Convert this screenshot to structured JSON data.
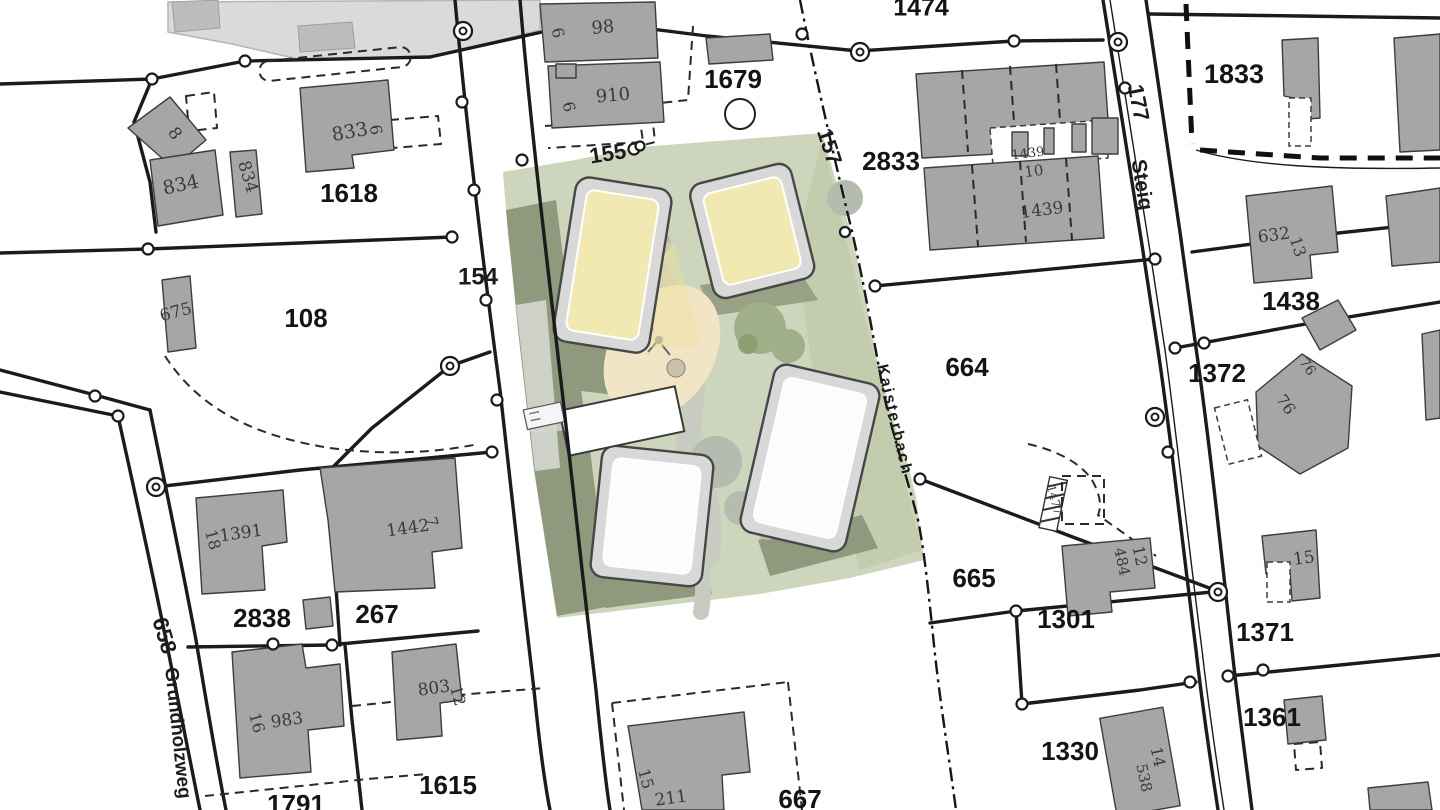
{
  "map": {
    "type": "cadastral-site-plan",
    "colors": {
      "background": "#ffffff",
      "boundary_line": "#1b1b1b",
      "building_fill": "#a6a6a6",
      "pale_building_fill": "#dadada",
      "site_green": "#cdd6bc",
      "site_shadow": "#8f997d",
      "roof_yellow": "#f2e8b2",
      "roof_white": "#fcfcfc",
      "playground_sand": "#f1e5c5",
      "path_gray": "#c7cbc0"
    },
    "labels": {
      "parcels": [
        {
          "text": "1474",
          "x": 921,
          "y": 9,
          "rot": 0,
          "size": 25
        },
        {
          "text": "1679",
          "x": 733,
          "y": 81,
          "rot": 0,
          "size": 26
        },
        {
          "text": "2833",
          "x": 891,
          "y": 163,
          "rot": 0,
          "size": 26
        },
        {
          "text": "1833",
          "x": 1234,
          "y": 76,
          "rot": 0,
          "size": 27
        },
        {
          "text": "1618",
          "x": 349,
          "y": 195,
          "rot": 0,
          "size": 26
        },
        {
          "text": "108",
          "x": 306,
          "y": 320,
          "rot": 0,
          "size": 26
        },
        {
          "text": "1438",
          "x": 1291,
          "y": 303,
          "rot": 0,
          "size": 26
        },
        {
          "text": "1372",
          "x": 1217,
          "y": 375,
          "rot": 0,
          "size": 26
        },
        {
          "text": "664",
          "x": 967,
          "y": 369,
          "rot": 0,
          "size": 26
        },
        {
          "text": "665",
          "x": 974,
          "y": 580,
          "rot": 0,
          "size": 26
        },
        {
          "text": "1301",
          "x": 1066,
          "y": 621,
          "rot": 0,
          "size": 26
        },
        {
          "text": "1371",
          "x": 1265,
          "y": 634,
          "rot": 0,
          "size": 26
        },
        {
          "text": "1361",
          "x": 1272,
          "y": 719,
          "rot": 0,
          "size": 26
        },
        {
          "text": "1330",
          "x": 1070,
          "y": 753,
          "rot": 0,
          "size": 26
        },
        {
          "text": "2838",
          "x": 262,
          "y": 620,
          "rot": 0,
          "size": 26
        },
        {
          "text": "267",
          "x": 377,
          "y": 616,
          "rot": 0,
          "size": 26
        },
        {
          "text": "1615",
          "x": 448,
          "y": 787,
          "rot": 0,
          "size": 26
        },
        {
          "text": "1791",
          "x": 296,
          "y": 806,
          "rot": 0,
          "size": 26
        },
        {
          "text": "667",
          "x": 800,
          "y": 801,
          "rot": 0,
          "size": 26
        }
      ],
      "streets": [
        {
          "text": "154",
          "x": 478,
          "y": 278,
          "rot": 0,
          "size": 24
        },
        {
          "text": "155",
          "x": 608,
          "y": 155,
          "rot": -9,
          "size": 22
        },
        {
          "text": "157",
          "x": 828,
          "y": 147,
          "rot": 72,
          "size": 22
        },
        {
          "text": "177",
          "x": 1137,
          "y": 103,
          "rot": 79,
          "size": 22
        },
        {
          "text": "658",
          "x": 163,
          "y": 636,
          "rot": 73,
          "size": 22
        },
        {
          "text": "Steig",
          "x": 1141,
          "y": 185,
          "rot": 81,
          "size": 21
        },
        {
          "text": "Grundholzweg",
          "x": 177,
          "y": 733,
          "rot": 84,
          "size": 19
        },
        {
          "text": "Kaisterbach",
          "x": 894,
          "y": 420,
          "rot": 77,
          "size": 16,
          "ls": 2
        }
      ],
      "buildings": [
        {
          "text": "834",
          "x": 181,
          "y": 186,
          "rot": -12,
          "size": 19
        },
        {
          "text": "834",
          "x": 247,
          "y": 177,
          "rot": 73,
          "size": 17
        },
        {
          "text": "8",
          "x": 174,
          "y": 134,
          "rot": 55,
          "size": 17
        },
        {
          "text": "833",
          "x": 350,
          "y": 133,
          "rot": -10,
          "size": 19
        },
        {
          "text": "6",
          "x": 375,
          "y": 130,
          "rot": 80,
          "size": 16
        },
        {
          "text": "98",
          "x": 603,
          "y": 28,
          "rot": -5,
          "size": 18
        },
        {
          "text": "6",
          "x": 557,
          "y": 33,
          "rot": 76,
          "size": 16
        },
        {
          "text": "910",
          "x": 613,
          "y": 96,
          "rot": -5,
          "size": 18
        },
        {
          "text": "6",
          "x": 568,
          "y": 107,
          "rot": 76,
          "size": 16
        },
        {
          "text": "675",
          "x": 176,
          "y": 313,
          "rot": -15,
          "size": 17
        },
        {
          "text": "1439",
          "x": 1028,
          "y": 154,
          "rot": -7,
          "size": 13
        },
        {
          "text": "10",
          "x": 1034,
          "y": 172,
          "rot": -7,
          "size": 15
        },
        {
          "text": "1439",
          "x": 1042,
          "y": 211,
          "rot": -7,
          "size": 17
        },
        {
          "text": "632",
          "x": 1274,
          "y": 236,
          "rot": -8,
          "size": 17
        },
        {
          "text": "13",
          "x": 1297,
          "y": 247,
          "rot": 72,
          "size": 16
        },
        {
          "text": "76",
          "x": 1285,
          "y": 405,
          "rot": 55,
          "size": 16
        },
        {
          "text": "76",
          "x": 1307,
          "y": 367,
          "rot": 55,
          "size": 14
        },
        {
          "text": "1391",
          "x": 241,
          "y": 534,
          "rot": -8,
          "size": 17
        },
        {
          "text": "18",
          "x": 212,
          "y": 540,
          "rot": 75,
          "size": 16
        },
        {
          "text": "1442",
          "x": 408,
          "y": 529,
          "rot": -8,
          "size": 17
        },
        {
          "text": "7",
          "x": 431,
          "y": 522,
          "rot": 75,
          "size": 15
        },
        {
          "text": "983",
          "x": 287,
          "y": 721,
          "rot": -8,
          "size": 17
        },
        {
          "text": "16",
          "x": 256,
          "y": 723,
          "rot": 75,
          "size": 16
        },
        {
          "text": "803",
          "x": 434,
          "y": 689,
          "rot": -8,
          "size": 17
        },
        {
          "text": "12",
          "x": 457,
          "y": 696,
          "rot": 75,
          "size": 16
        },
        {
          "text": "211",
          "x": 671,
          "y": 799,
          "rot": -8,
          "size": 17
        },
        {
          "text": "15",
          "x": 645,
          "y": 779,
          "rot": 75,
          "size": 16
        },
        {
          "text": "484",
          "x": 1121,
          "y": 562,
          "rot": 78,
          "size": 15
        },
        {
          "text": "12",
          "x": 1139,
          "y": 556,
          "rot": 78,
          "size": 16
        },
        {
          "text": "538",
          "x": 1143,
          "y": 778,
          "rot": 78,
          "size": 15
        },
        {
          "text": "14",
          "x": 1157,
          "y": 757,
          "rot": 78,
          "size": 16
        },
        {
          "text": "15",
          "x": 1304,
          "y": 559,
          "rot": -8,
          "size": 17
        },
        {
          "text": "1477",
          "x": 1054,
          "y": 500,
          "rot": 75,
          "size": 12
        }
      ]
    }
  }
}
